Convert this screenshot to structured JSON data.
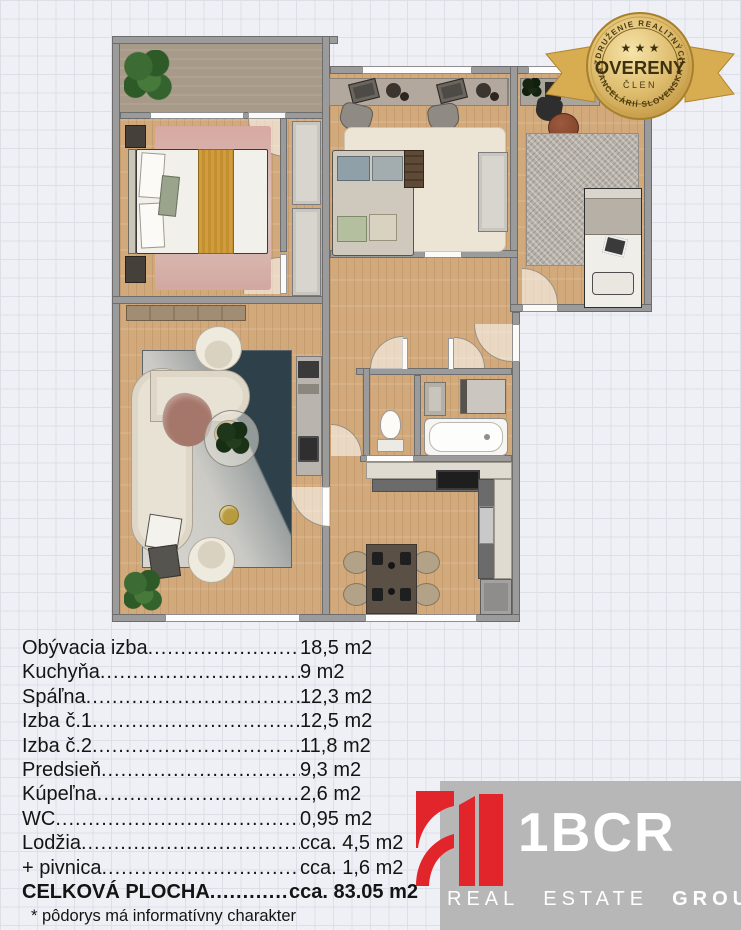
{
  "colors": {
    "bg": "#eef0f5",
    "grid": "#dcdfe8",
    "grid2": "#ccd0dc",
    "wall": "#9b9b9b",
    "wood": "#d2a97b",
    "loggia": "#a89a88",
    "badge-gold": "#d9b765",
    "badge-text": "#3e3110",
    "logo-red": "#e2242b",
    "logo-gray": "#b7b7b8"
  },
  "badge": {
    "top_text": "ZDRUŽENIE REALITNÝCH",
    "bottom_text": "KANCELÁRIÍ SLOVENSKA",
    "stars": "★ ★ ★",
    "title": "OVERENÝ",
    "subtitle": "ČLEN"
  },
  "area_table": {
    "rows": [
      {
        "label": "Obývacia izba",
        "value": "18,5 m2"
      },
      {
        "label": "Kuchyňa",
        "value": "9 m2"
      },
      {
        "label": "Spáľna",
        "value": "12,3 m2"
      },
      {
        "label": "Izba č.1",
        "value": "12,5 m2"
      },
      {
        "label": "Izba č.2",
        "value": "11,8 m2"
      },
      {
        "label": "Predsieň",
        "value": "9,3 m2"
      },
      {
        "label": "Kúpeľna",
        "value": "2,6 m2"
      },
      {
        "label": "WC",
        "value": "0,95 m2"
      },
      {
        "label": "Lodžia",
        "value": "cca. 4,5 m2"
      },
      {
        "label": "+ pivnica",
        "value": "cca. 1,6 m2"
      }
    ],
    "total": {
      "label": "CELKOVÁ PLOCHA",
      "value": "cca. 83.05 m2"
    },
    "footnote": "* pôdorys má informatívny charakter"
  },
  "logo": {
    "brand": "1BCR",
    "tagline": [
      "REAL",
      "ESTATE",
      "GROUP"
    ]
  }
}
